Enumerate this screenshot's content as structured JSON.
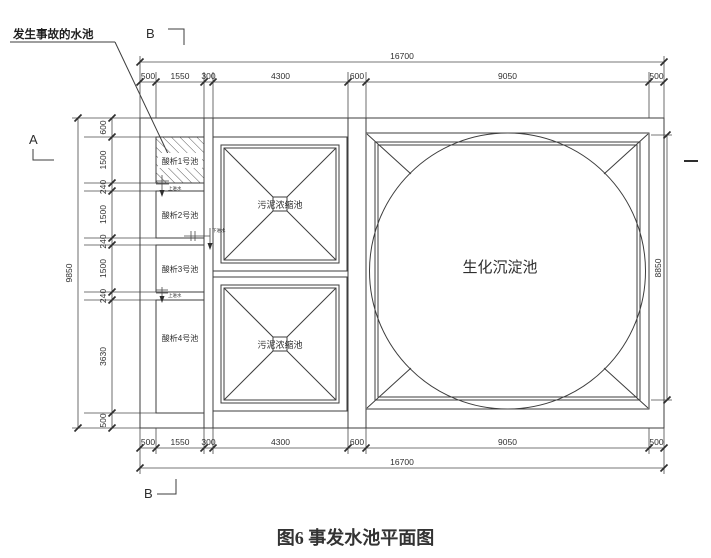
{
  "caption": "图6 事发水池平面图",
  "leader_label": "发生事故的水池",
  "section_markers": {
    "a": "A",
    "b_top": "B",
    "b_bottom": "B"
  },
  "pools": {
    "acid1": "酸析1号池",
    "acid2": "酸析2号池",
    "acid3": "酸析3号池",
    "acid4": "酸析4号池",
    "sludge_upper": "污泥浓缩池",
    "sludge_lower": "污泥浓缩池",
    "bio": "生化沉淀池"
  },
  "inlets": {
    "upper1": "上进水",
    "lower": "下进水",
    "upper2": "上进水"
  },
  "dimensions": {
    "top": {
      "overall": "16700",
      "segments": [
        "500",
        "1550",
        "300",
        "4300",
        "600",
        "9050",
        "500"
      ]
    },
    "bottom": {
      "overall": "16700",
      "segments": [
        "500",
        "1550",
        "300",
        "4300",
        "600",
        "9050",
        "500"
      ]
    },
    "left": {
      "overall": "9850",
      "segments": [
        "600",
        "1500",
        "240",
        "1500",
        "240",
        "1500",
        "240",
        "3630",
        "500"
      ]
    },
    "right": {
      "overall": "8850"
    }
  },
  "colors": {
    "line": "#3d3d3d",
    "text": "#2e2e2e"
  }
}
